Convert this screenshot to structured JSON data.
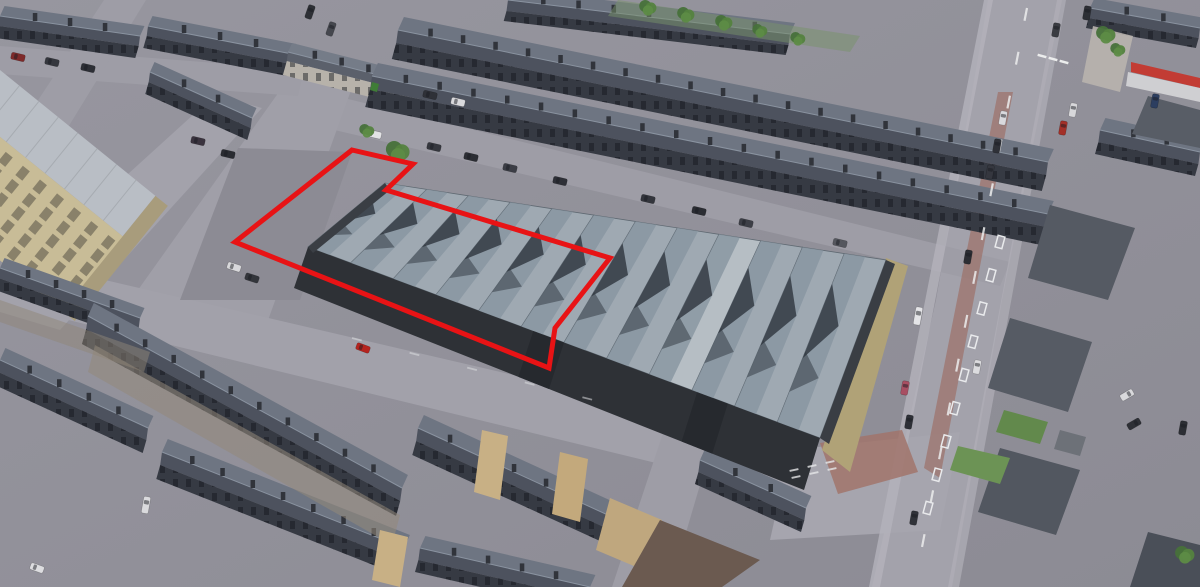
{
  "view": {
    "description": "aerial-3d-oblique-view-with-property-boundary-overlay",
    "canvas_w": 1200,
    "canvas_h": 587
  },
  "overlay": {
    "points": "352,150 413,164 386,190 610,258 555,328 549,368 235,242",
    "color": "#e81315",
    "width": 5
  },
  "palette": {
    "ground": "#92919a",
    "road": "#a3a2ab",
    "roof_light": "#9fa9b2",
    "roof_shadow": "#2e353d",
    "dark_wall": "#2e3136",
    "slate_roof_back": "#6e7582",
    "slate_roof_front": "#4d525e",
    "terrace_facade": "#363a43",
    "mill_stone": "#c8bc97",
    "tan_gable": "#c8b085",
    "grass": "#62894c",
    "boundary_red": "#e81315"
  },
  "scene": {
    "roads": [
      {
        "name": "main-road",
        "points": "988,0 1062,0 1002,300 952,587 872,587 936,300",
        "fill": "#a3a2ab"
      },
      {
        "name": "back-street",
        "points": "336,96 1010,262 1000,286 326,128",
        "fill": "#9e9da6"
      },
      {
        "name": "cross-street-left",
        "points": "296,68 354,82 258,348 118,318",
        "fill": "#a09fa8"
      },
      {
        "name": "mill-front-street",
        "points": "215,95 262,108 60,330 0,312 0,290",
        "fill": "#a3a2ab"
      },
      {
        "name": "front-street",
        "points": "88,276 818,446 800,498 60,318",
        "fill": "#a2a1aa"
      },
      {
        "name": "cross-street-bottom",
        "points": "664,430 712,444 670,587 612,587",
        "fill": "#9e9da6"
      },
      {
        "name": "street-topleft",
        "points": "0,46 304,70 298,96 0,74",
        "fill": "#9e9da6"
      },
      {
        "name": "street-mill-top",
        "points": "104,0 146,0 26,196 0,186 0,158",
        "fill": "#9e9da6"
      },
      {
        "name": "junction",
        "points": "790,450 960,432 940,530 770,540",
        "fill": "#a6a5ae"
      },
      {
        "name": "yard-patch",
        "points": "238,148 352,152 300,300 180,300",
        "fill": "#8c8b94"
      }
    ],
    "sidewalks": [
      {
        "name": "sidewalk-left",
        "points": "984,0 993,0 880,587 869,587",
        "fill": "#b4b3bb",
        "opacity": 0.8
      },
      {
        "name": "sidewalk-right",
        "points": "1057,0 1066,0 959,587 948,587",
        "fill": "#b0afb8",
        "opacity": 0.7
      },
      {
        "name": "sidewalk-brick",
        "points": "998,92 1013,92 940,478 924,468",
        "fill": "#9c7168",
        "opacity": 0.7
      },
      {
        "name": "junction-brick",
        "points": "820,443 902,430 918,472 838,494",
        "fill": "#a1746b",
        "opacity": 0.85
      }
    ],
    "rows": [
      {
        "name": "terrace-topleft",
        "x1": 0,
        "y1": 16,
        "x2": 140,
        "y2": 36,
        "hd": 10,
        "fh": 12,
        "step": 30
      },
      {
        "name": "terrace-topleft-2",
        "x1": 148,
        "y1": 26,
        "x2": 292,
        "y2": 54,
        "hd": 10,
        "fh": 12,
        "step": 30
      },
      {
        "name": "terrace-shops-white",
        "x1": 288,
        "y1": 52,
        "x2": 422,
        "y2": 86,
        "hd": 9,
        "fh": 14,
        "step": 26,
        "facade": "#b7b2aa",
        "roof_front": "#5b606b",
        "roof_back": "#757c88"
      },
      {
        "name": "terrace-top-fragment",
        "x1": 508,
        "y1": 0,
        "x2": 790,
        "y2": 34,
        "hd": 11,
        "fh": 10,
        "step": 32
      },
      {
        "name": "terrace-row-1",
        "x1": 398,
        "y1": 30,
        "x2": 1048,
        "y2": 162,
        "hd": 13,
        "fh": 16,
        "step": 33
      },
      {
        "name": "terrace-row-2",
        "x1": 372,
        "y1": 76,
        "x2": 1048,
        "y2": 214,
        "hd": 13,
        "fh": 18,
        "step": 33
      },
      {
        "name": "terrace-mill-row",
        "x1": 150,
        "y1": 72,
        "x2": 252,
        "y2": 118,
        "hd": 10,
        "fh": 12,
        "step": 28
      },
      {
        "name": "terrace-left-edge",
        "x1": 0,
        "y1": 268,
        "x2": 140,
        "y2": 318,
        "hd": 10,
        "fh": 12,
        "step": 28
      },
      {
        "name": "terrace-bottomleft-0",
        "x1": 0,
        "y1": 360,
        "x2": 148,
        "y2": 428,
        "hd": 12,
        "fh": 13,
        "step": 30
      },
      {
        "name": "terrace-bottomleft-a",
        "x1": 88,
        "y1": 316,
        "x2": 402,
        "y2": 488,
        "hd": 13,
        "fh": 15,
        "step": 32
      },
      {
        "name": "terrace-bottomleft-b",
        "x1": 162,
        "y1": 452,
        "x2": 404,
        "y2": 548,
        "hd": 13,
        "fh": 14,
        "step": 32
      },
      {
        "name": "terrace-bottomleft-c",
        "x1": 420,
        "y1": 548,
        "x2": 590,
        "y2": 587,
        "hd": 12,
        "fh": 12,
        "step": 30
      },
      {
        "name": "terrace-bottomcenter",
        "x1": 418,
        "y1": 428,
        "x2": 706,
        "y2": 560,
        "hd": 13,
        "fh": 14,
        "step": 32
      },
      {
        "name": "terrace-bottomcenter-2",
        "x1": 700,
        "y1": 460,
        "x2": 806,
        "y2": 508,
        "hd": 12,
        "fh": 12,
        "step": 30
      },
      {
        "name": "house-right-top",
        "x1": 1090,
        "y1": 8,
        "x2": 1200,
        "y2": 28,
        "hd": 10,
        "fh": 10,
        "step": 34
      },
      {
        "name": "house-right-2",
        "x1": 1100,
        "y1": 130,
        "x2": 1200,
        "y2": 152,
        "hd": 12,
        "fh": 12,
        "step": 34
      }
    ],
    "blocks": [
      {
        "name": "gardens-top",
        "points": "618,0 860,36 850,52 608,16",
        "fill": "#77926a",
        "opacity": 0.5
      },
      {
        "name": "backyards-bottomleft",
        "points": "95,345 400,515 392,545 88,372",
        "fill": "#94897a",
        "opacity": 0.55
      },
      {
        "name": "backyards-bottomleft-2",
        "points": "0,300 150,352 144,372 0,322",
        "fill": "#8f8577",
        "opacity": 0.5
      },
      {
        "name": "house-right-mid",
        "points": "1050,205 1135,228 1108,300 1028,278",
        "fill": "#555a63"
      },
      {
        "name": "house-right-4",
        "points": "1148,96 1200,110 1200,148 1132,134",
        "fill": "#585d66"
      },
      {
        "name": "hip-house-1",
        "points": "1010,318 1092,342 1068,412 988,388",
        "fill": "#565b64"
      },
      {
        "name": "hip-house-2",
        "points": "1000,448 1080,470 1056,535 978,512",
        "fill": "#525760"
      },
      {
        "name": "hip-house-3",
        "points": "1148,532 1200,545 1200,587 1130,587",
        "fill": "#4a4f58"
      },
      {
        "name": "shop-awning",
        "points": "1131,62 1200,78 1200,88 1131,72",
        "fill": "#c23c34"
      },
      {
        "name": "shop-front",
        "points": "1128,72 1200,88 1200,102 1126,86",
        "fill": "#cfcfd2"
      },
      {
        "name": "driveway-right-top",
        "points": "1093,26 1133,36 1120,92 1082,82",
        "fill": "#b9b4ae",
        "opacity": 0.9
      },
      {
        "name": "gable-end-1",
        "points": "482,430 508,436 500,500 474,492",
        "fill": "#c8b085"
      },
      {
        "name": "gable-end-2",
        "points": "560,452 588,459 580,522 552,514",
        "fill": "#c3a97c"
      },
      {
        "name": "gable-end-3",
        "points": "380,530 408,537 400,587 372,580",
        "fill": "#c8b085"
      },
      {
        "name": "tan-house-wall",
        "points": "610,498 662,520 648,572 596,550",
        "fill": "#bfa77e"
      },
      {
        "name": "brown-roof-house",
        "points": "660,520 760,560 722,587 622,587",
        "fill": "#6b5a50"
      },
      {
        "name": "garden-shed-right",
        "points": "1060,430 1086,437 1080,456 1054,449",
        "fill": "#6d7178"
      },
      {
        "name": "garden-1",
        "points": "1004,410 1048,422 1040,444 996,432",
        "fill": "#62894c"
      },
      {
        "name": "garden-2",
        "points": "958,446 1010,458 1000,484 950,470",
        "fill": "#6c9355"
      },
      {
        "name": "green-bin",
        "points": "372,82 379,84 377,92 370,90",
        "fill": "#3f7d36"
      }
    ],
    "mill": {
      "translate": [
        0,
        70
      ],
      "rotate": 39,
      "roof": {
        "w": 200,
        "h": 52,
        "fill": "#b9bec5"
      },
      "facade": {
        "y": 52,
        "w": 210,
        "h": 96,
        "fill": "#c8bc97"
      },
      "end": {
        "x": 200,
        "w": 16,
        "h": 148,
        "fill": "#a89c7c"
      },
      "windows": {
        "cols": 9,
        "rows": 5,
        "w": 9,
        "h": 12,
        "fill": "#746e5b"
      }
    },
    "warehouse": {
      "front": [
        [
          308,
          247
        ],
        [
          820,
          438
        ]
      ],
      "back": [
        [
          385,
          183
        ],
        [
          886,
          260
        ]
      ],
      "wall_bottom": [
        [
          294,
          288
        ],
        [
          804,
          490
        ]
      ],
      "strips": 12,
      "pale_strip": 8,
      "gravel_points": "886,258 908,266 850,472 822,450",
      "doors": [
        [
          0.44,
          0.5
        ],
        [
          0.76,
          0.82
        ]
      ],
      "colors": {
        "roof_light": "#9fa9b2",
        "roof_mid": "#8795a0",
        "roof_pale": "#b6bec4",
        "valley": "#5f6972",
        "chevron": "#2e353d",
        "wall": "#2e3136",
        "door": "#26292e",
        "end_wall": "#3a3e44",
        "gravel": "#b0a277",
        "back_wall": "#41454c"
      }
    },
    "markings": {
      "center_dash": {
        "from": [
          1027,
          8
        ],
        "to": [
          916,
          578
        ],
        "count": 13,
        "len": 13,
        "color": "#eceded",
        "width": 2.2,
        "opacity": 0.85
      },
      "hatch": {
        "from": [
          1000,
          242
        ],
        "to": [
          928,
          508
        ],
        "count": 9,
        "w": 12,
        "h": 7,
        "angle": 105,
        "color": "#e9eaec"
      },
      "crossing": {
        "points": [
          [
            1042,
            56
          ],
          [
            1053,
            59
          ],
          [
            1064,
            62
          ]
        ],
        "angle": 15,
        "len": 9,
        "width": 2.5,
        "color": "#eceded"
      },
      "giveway": {
        "points": [
          [
            794,
            470
          ],
          [
            812,
            466
          ],
          [
            830,
            462
          ],
          [
            796,
            477
          ],
          [
            814,
            473
          ],
          [
            832,
            469
          ]
        ],
        "angle": -12,
        "len": 9,
        "width": 2,
        "color": "#e6e7e9",
        "opacity": 0.8
      },
      "street_dash": {
        "from": [
          352,
          338
        ],
        "to": [
          640,
          412
        ],
        "count": 5,
        "len": 10,
        "color": "#dcdde0",
        "width": 1.8,
        "opacity": 0.55
      }
    },
    "cars": [
      [
        373,
        134,
        13,
        "#e3e3e6",
        17
      ],
      [
        434,
        147,
        13,
        "#35373e"
      ],
      [
        471,
        157,
        13,
        "#2c2e34"
      ],
      [
        510,
        168,
        13,
        "#3b3d45"
      ],
      [
        560,
        181,
        13,
        "#2e3037"
      ],
      [
        648,
        199,
        13,
        "#33353c"
      ],
      [
        699,
        211,
        13,
        "#2b2d33"
      ],
      [
        746,
        223,
        13,
        "#3d3f47"
      ],
      [
        840,
        243,
        13,
        "#55575e"
      ],
      [
        18,
        57,
        13,
        "#7e2a2a"
      ],
      [
        52,
        62,
        13,
        "#35373e"
      ],
      [
        88,
        68,
        13,
        "#2d2f36"
      ],
      [
        430,
        95,
        13,
        "#2f3138"
      ],
      [
        458,
        102,
        13,
        "#d9d9dc"
      ],
      [
        310,
        12,
        109,
        "#2e3036"
      ],
      [
        331,
        29,
        109,
        "#45474e"
      ],
      [
        198,
        141,
        13,
        "#3a333e"
      ],
      [
        228,
        154,
        13,
        "#2a2c32"
      ],
      [
        234,
        267,
        18,
        "#d8d8db"
      ],
      [
        252,
        278,
        18,
        "#33353b"
      ],
      [
        363,
        348,
        20,
        "#b5241f"
      ],
      [
        1003,
        118,
        100,
        "#d9d9dd"
      ],
      [
        997,
        146,
        100,
        "#2f3138"
      ],
      [
        990,
        172,
        100,
        "#35373f"
      ],
      [
        968,
        257,
        100,
        "#2b2d33"
      ],
      [
        918,
        316,
        100,
        "#e4e4e7",
        18
      ],
      [
        905,
        388,
        100,
        "#a84f63"
      ],
      [
        909,
        422,
        100,
        "#2e3037"
      ],
      [
        1056,
        30,
        100,
        "#3a3c42"
      ],
      [
        1087,
        13,
        100,
        "#2d2f35"
      ],
      [
        1073,
        110,
        100,
        "#d7d7da"
      ],
      [
        1063,
        128,
        100,
        "#a33028"
      ],
      [
        1155,
        101,
        100,
        "#2c3e60"
      ],
      [
        977,
        367,
        100,
        "#dcdcdf"
      ],
      [
        914,
        518,
        100,
        "#303239"
      ],
      [
        1183,
        428,
        100,
        "#2c2e34"
      ],
      [
        37,
        568,
        20,
        "#dddde0"
      ],
      [
        146,
        505,
        100,
        "#dadadd",
        17
      ],
      [
        1127,
        395,
        150,
        "#d9d9dc"
      ],
      [
        1134,
        424,
        150,
        "#2e3036"
      ]
    ],
    "trees": [
      [
        398,
        152,
        11
      ],
      [
        367,
        131,
        7
      ],
      [
        1106,
        35,
        9
      ],
      [
        1118,
        50,
        7
      ],
      [
        648,
        8,
        8
      ],
      [
        686,
        15,
        8
      ],
      [
        724,
        23,
        8
      ],
      [
        760,
        31,
        7
      ],
      [
        798,
        39,
        7
      ],
      [
        1185,
        555,
        9
      ]
    ]
  }
}
